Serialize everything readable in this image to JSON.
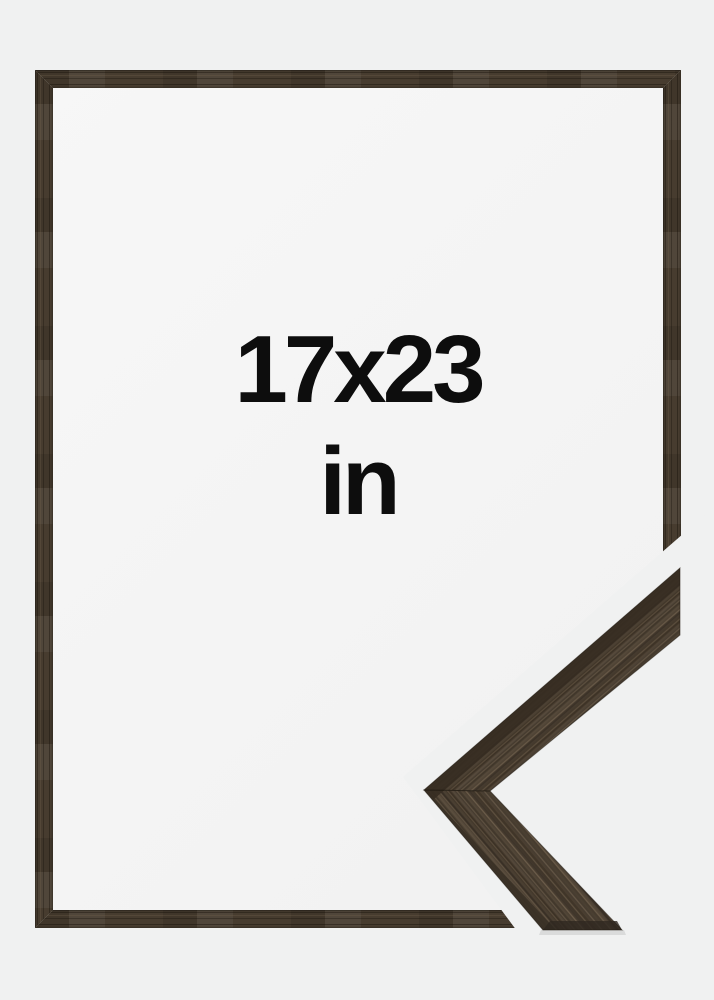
{
  "product_preview": {
    "size_label": "17x23",
    "unit_label": "in",
    "graphics": {
      "frame_preview": "empty brown wood picture frame",
      "corner_detail": "close-up of mitered frame corner moulding"
    },
    "colors": {
      "background": "#f0f1f1",
      "interior_light": "#f7f7f7",
      "interior_dark": "#f1f1f1",
      "text": "#0d0d0d",
      "wood_base": "#473c2f",
      "wood_dark": "#33291f",
      "wood_light": "#6b5c49"
    }
  }
}
